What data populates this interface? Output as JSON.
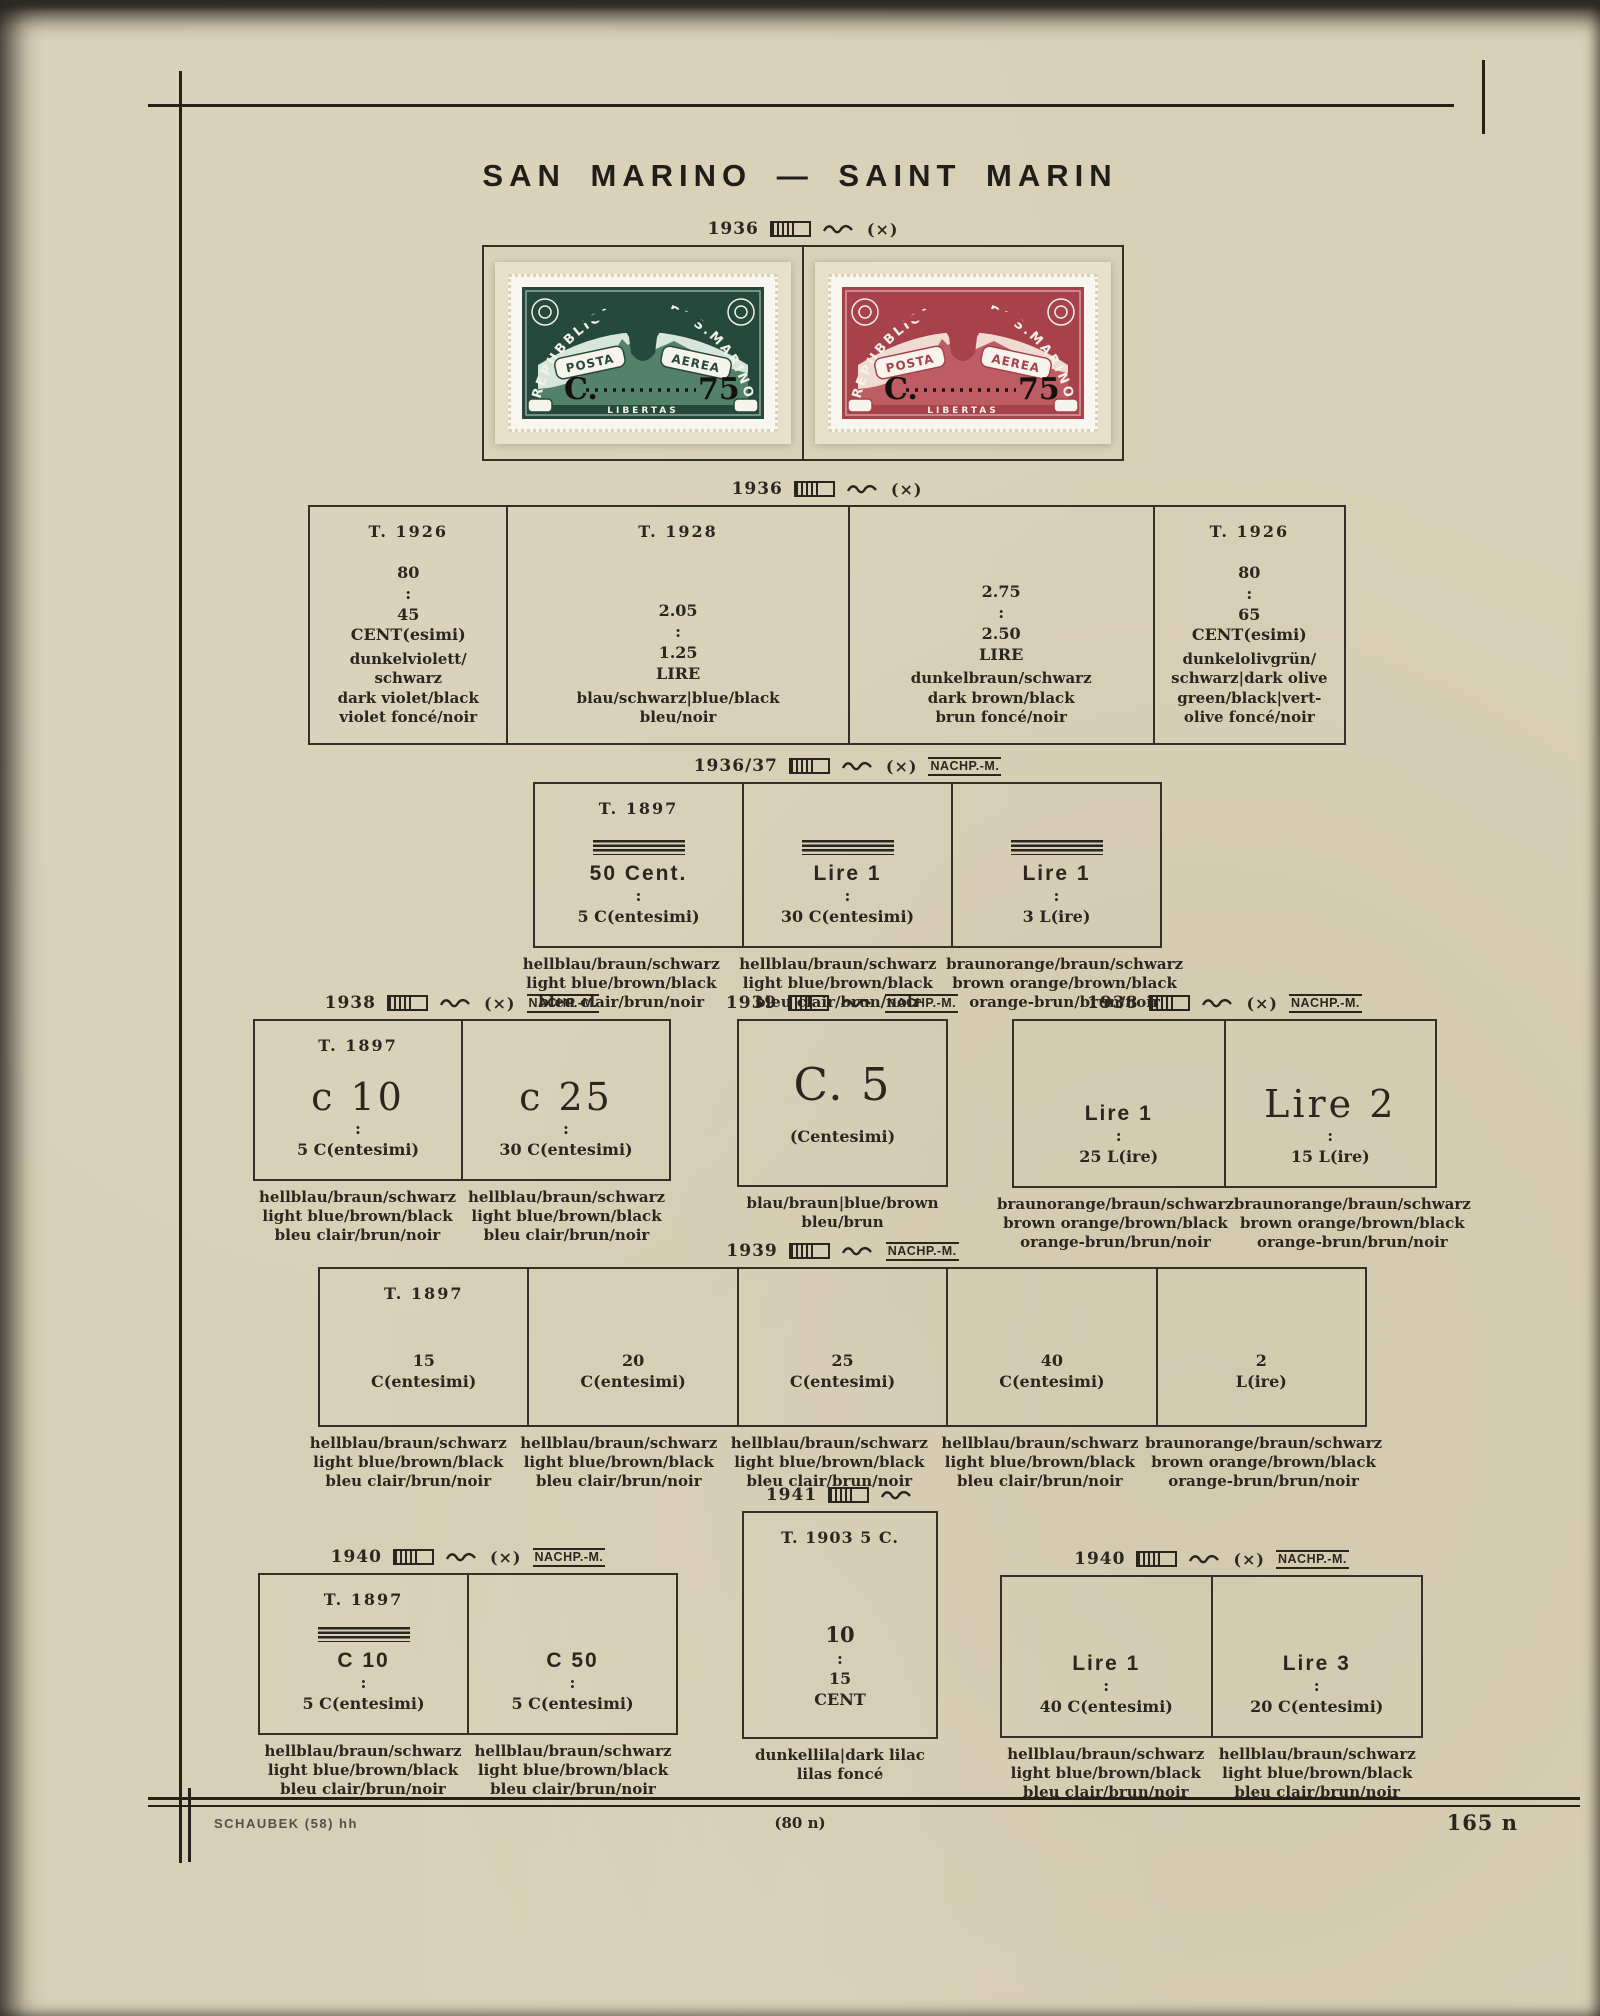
{
  "page": {
    "title": "SAN MARINO — SAINT MARIN",
    "footer": {
      "left": "SCHAUBEK  (58)  hh",
      "center": "(80 n)",
      "right": "165 n"
    }
  },
  "symbols": {
    "cross": "(×)",
    "nachp": "NACHP.-M."
  },
  "stamp_text": {
    "republica": "REPUBBLICA",
    "di_s_marino": "DI S.MARINO",
    "posta": "POSTA",
    "aerea": "AEREA",
    "c": "C.",
    "v75": "75",
    "libertas": "LIBERTAS"
  },
  "stamps": {
    "left": {
      "style": "--panel:#25493c;--sky:#d8e5da;--mtn:#54816a",
      "ink": "#25493c"
    },
    "right": {
      "style": "--panel:#a7414a;--sky:#f0dbd3;--mtn:#bd5d63",
      "ink": "#a7414a"
    }
  },
  "caps": {
    "blue": [
      "hellblau/braun/schwarz",
      "light blue/brown/black",
      "bleu  clair/brun/noir"
    ],
    "orange": [
      "braunorange/braun/schwarz",
      "brown orange/brown/black",
      "orange-brun/brun/noir"
    ],
    "bluebrown": [
      "blau/braun|blue/brown",
      "bleu/brun"
    ],
    "lilac": [
      "dunkellila|dark lilac",
      "lilas foncé"
    ]
  },
  "sections": {
    "s1": {
      "year": "1936"
    },
    "s2": {
      "year": "1936",
      "cells": [
        {
          "type": "T. 1926",
          "stack": [
            "80",
            ":",
            "45",
            "CENT(esimi)"
          ],
          "colors": [
            "dunkelviolett/",
            "schwarz",
            "dark violet/black",
            "violet foncé/noir"
          ]
        },
        {
          "type": "T. 1928",
          "stack": [
            "2.05",
            ":",
            "1.25",
            "LIRE"
          ],
          "colors": [
            "blau/schwarz|blue/black",
            "bleu/noir"
          ]
        },
        {
          "stack": [
            "2.75",
            ":",
            "2.50",
            "LIRE"
          ],
          "colors": [
            "dunkelbraun/schwarz",
            "dark brown/black",
            "brun foncé/noir"
          ]
        },
        {
          "type": "T. 1926",
          "stack": [
            "80",
            ":",
            "65",
            "CENT(esimi)"
          ],
          "colors": [
            "dunkelolivgrün/",
            "schwarz|dark olive",
            "green/black|vert-",
            "olive foncé/noir"
          ]
        }
      ]
    },
    "s3": {
      "year": "1936/37",
      "cells": [
        {
          "type": "T. 1897",
          "big": "50 Cent.",
          "stack": [
            ":",
            "5 C(entesimi)"
          ]
        },
        {
          "big": "Lire 1",
          "stack": [
            ":",
            "30 C(entesimi)"
          ]
        },
        {
          "big": "Lire 1",
          "stack": [
            ":",
            "3 L(ire)"
          ]
        }
      ]
    },
    "r3a": {
      "year": "1938",
      "cells": [
        {
          "type": "T. 1897",
          "big": "c 10",
          "stack": [
            ":",
            "5 C(entesimi)"
          ]
        },
        {
          "big": "c 25",
          "stack": [
            ":",
            "30 C(entesimi)"
          ]
        }
      ]
    },
    "r3b": {
      "year": "1939",
      "cells": [
        {
          "big": "C. 5",
          "stack": [
            "(Centesimi)"
          ]
        }
      ]
    },
    "r3c": {
      "year": "1938",
      "cells": [
        {
          "big": "Lire 1",
          "stack": [
            ":",
            "25 L(ire)"
          ]
        },
        {
          "big": "Lire 2",
          "stack": [
            ":",
            "15 L(ire)"
          ]
        }
      ]
    },
    "r4": {
      "year": "1939",
      "cells": [
        {
          "type": "T. 1897",
          "stack": [
            "15",
            "C(entesimi)"
          ]
        },
        {
          "stack": [
            "20",
            "C(entesimi)"
          ]
        },
        {
          "stack": [
            "25",
            "C(entesimi)"
          ]
        },
        {
          "stack": [
            "40",
            "C(entesimi)"
          ]
        },
        {
          "stack": [
            "2",
            "L(ire)"
          ]
        }
      ]
    },
    "r5l": {
      "year": "1940",
      "cells": [
        {
          "type": "T. 1897",
          "big": "C 10",
          "stack": [
            ":",
            "5 C(entesimi)"
          ]
        },
        {
          "big": "C 50",
          "stack": [
            ":",
            "5 C(entesimi)"
          ]
        }
      ]
    },
    "r5m": {
      "year": "1941",
      "cells": [
        {
          "type": "T. 1903  5 C.",
          "stack": [
            "10",
            ":",
            "15",
            "CENT"
          ]
        }
      ]
    },
    "r5r": {
      "year": "1940",
      "cells": [
        {
          "big": "Lire 1",
          "stack": [
            ":",
            "40 C(entesimi)"
          ]
        },
        {
          "big": "Lire 3",
          "stack": [
            ":",
            "20 C(entesimi)"
          ]
        }
      ]
    }
  }
}
